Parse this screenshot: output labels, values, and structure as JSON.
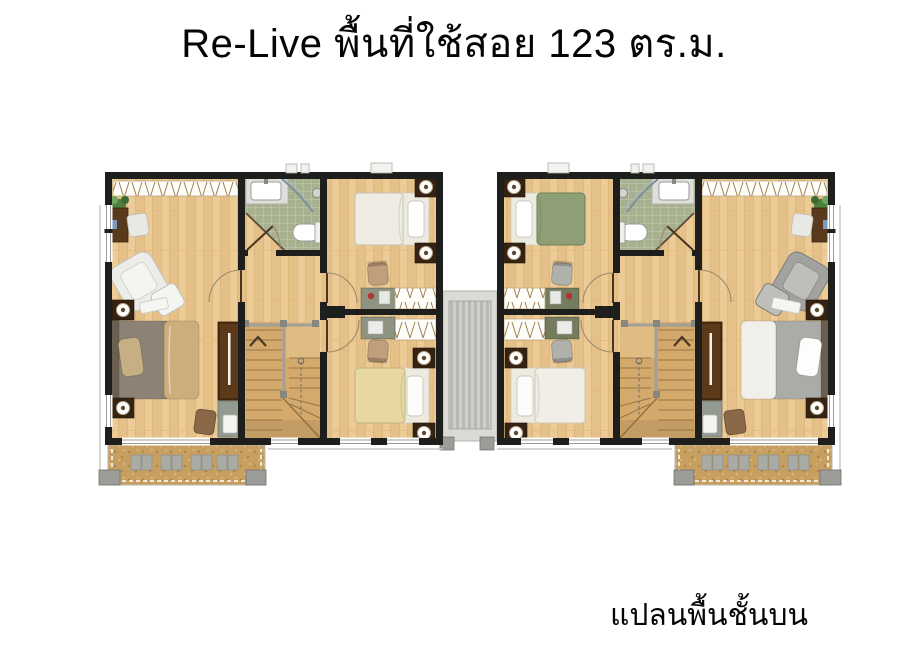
{
  "header": {
    "title": "Re-Live พื้นที่ใช้สอย 123 ตร.ม."
  },
  "footer": {
    "caption": "แปลนพื้นชั้นบน"
  },
  "plan": {
    "kind": "twin-house upper-floor plan, two mirrored units",
    "units": [
      {
        "id": "left-unit",
        "rooms": [
          "master-bedroom",
          "bathroom",
          "front-bedroom",
          "rear-bedroom",
          "stair-hall",
          "balcony"
        ]
      },
      {
        "id": "right-unit",
        "rooms": [
          "master-bedroom",
          "bathroom",
          "front-bedroom",
          "rear-bedroom",
          "stair-hall",
          "balcony"
        ]
      }
    ]
  },
  "colors": {
    "text": "#050505",
    "wall": "#1E1E1C",
    "floor-wood": "#EDCB96",
    "floor-wood-dark": "#E6C089",
    "floor-wood-line": "#D8B174",
    "bath-tile": "#A7B190",
    "bath-grout": "#C6CEB2",
    "balcony-floor": "#C79F60",
    "stair-wood": "#D3A96C",
    "stair-line": "#8F6B3C",
    "roof-stripe-a": "#CFCEC8",
    "roof-stripe-b": "#B9B8B2",
    "cabinet-brown": "#4A2D11",
    "desk-brown": "#5A3A1D",
    "metal-gray": "#9C9C98"
  },
  "colors_left": {
    "bed2": "#EFEDE3",
    "bed2-edge": "#C6C2B2",
    "bed3": "#E6D8A0",
    "bed3-edge": "#C2B273",
    "chair": "#C19E7C",
    "desk": "#8E9481",
    "arm": "#ECECE8",
    "arm-edge": "#C2C2BC",
    "arm-seat": "#F4F4F1",
    "mbed-head": "#8C8376",
    "mbed-foot": "#CBAE7C",
    "mbed-pillow": "#C6B083"
  },
  "colors_right": {
    "bed2": "#8E9F75",
    "bed2-edge": "#6E7F58",
    "bed3": "#F0EEE6",
    "bed3-edge": "#CCC8B8",
    "chair": "#B0B0AC",
    "desk": "#737C5D",
    "arm": "#A2A2A0",
    "arm-edge": "#7E7E7C",
    "arm-seat": "#BEBEBB",
    "mbed-head": "#ABABA7",
    "mbed-foot": "#F0EFE9",
    "mbed-pillow": "#FDFDFB"
  }
}
